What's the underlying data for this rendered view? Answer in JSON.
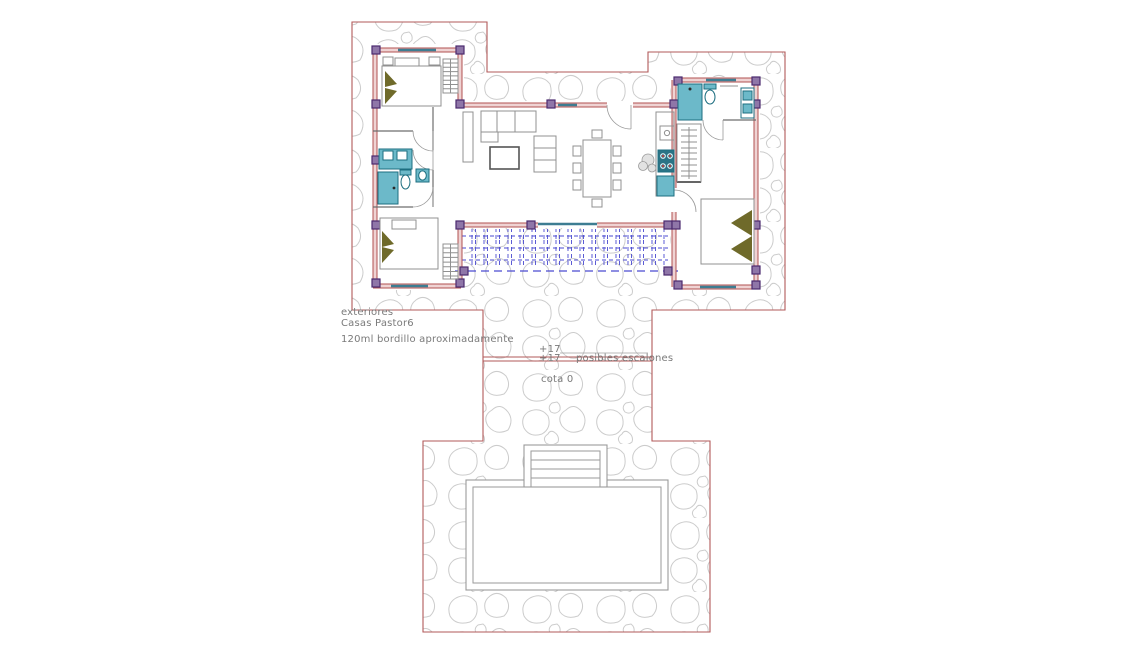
{
  "labels": {
    "exteriores": "exteriores",
    "project_name": "Casas Pastor6",
    "bordillo_note": "120ml bordillo aproximadamente",
    "level_upper": "+17",
    "level_lower": "+17",
    "steps_note": "posibles escalones",
    "ground_level": "cota 0"
  },
  "colors": {
    "boundary_red": "#b25a5a",
    "wall_edge": "#b05050",
    "wall_fill": "#efd3d3",
    "column_fill": "#8f76a8",
    "column_edge": "#4b2a6e",
    "teal_fill": "#6cb9c9",
    "teal_edge": "#1d6e80",
    "stove_fill": "#2a7486",
    "burner_red": "#cc3333",
    "pergola_blue": "#4a4ad0",
    "stone_gray": "#cccccc",
    "furniture_gray": "#909090",
    "furniture_dark": "#555555",
    "olive": "#6f6a2a",
    "window_teal": "#3d7d92",
    "pool_gray": "#9a9a9a",
    "text_gray": "#7a7a7a"
  }
}
